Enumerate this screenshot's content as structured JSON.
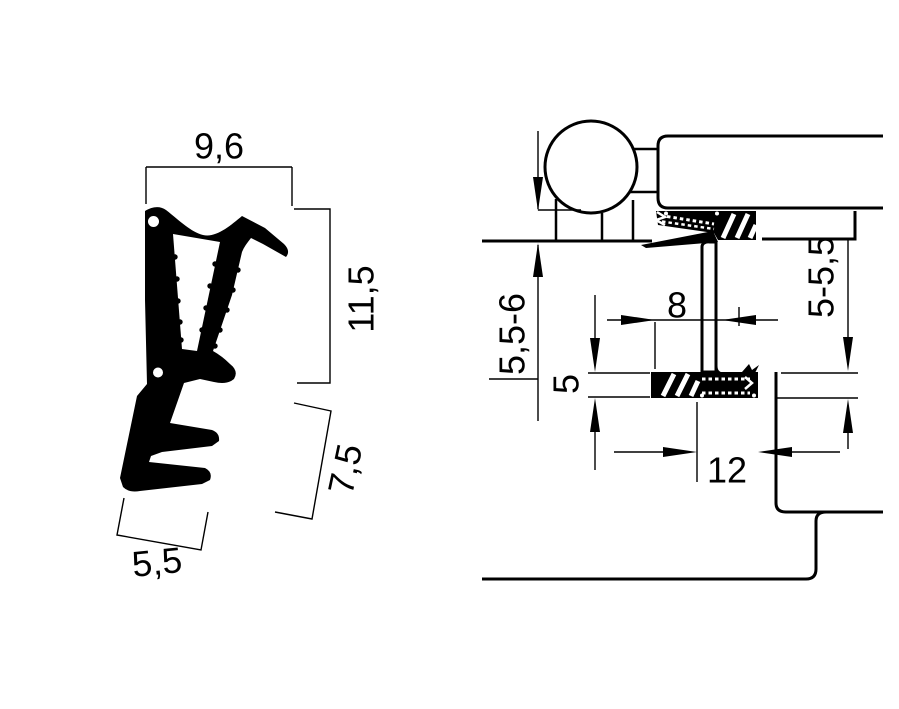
{
  "colors": {
    "background": "#ffffff",
    "ink": "#000000"
  },
  "left_figure": {
    "name": "seal profile cross-section",
    "dims": {
      "top_width": "9,6",
      "right_height": "11,5",
      "foot_length": "7,5",
      "bottom_width": "5,5"
    }
  },
  "right_figure": {
    "name": "installed window section",
    "dims": {
      "left_gap": "5,5-6",
      "groove_depth": "5",
      "air_gap": "8",
      "right_gap": "5-5,5",
      "rebate_width": "12"
    }
  }
}
